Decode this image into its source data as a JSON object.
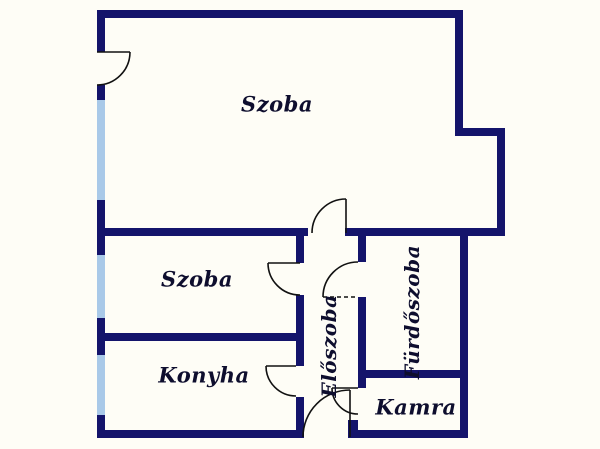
{
  "plan": {
    "colors": {
      "wall": "#14146b",
      "window": "#a9c9e8",
      "background": "#fefdf6",
      "label": "#0e0e2e",
      "door": "#111111"
    },
    "rooms": [
      {
        "id": "szoba-1",
        "label": "Szoba"
      },
      {
        "id": "szoba-2",
        "label": "Szoba"
      },
      {
        "id": "konyha",
        "label": "Konyha"
      },
      {
        "id": "eloszoba",
        "label": "Előszoba"
      },
      {
        "id": "furdoszoba",
        "label": "Fürdőszoba"
      },
      {
        "id": "kamra",
        "label": "Kamra"
      }
    ]
  }
}
